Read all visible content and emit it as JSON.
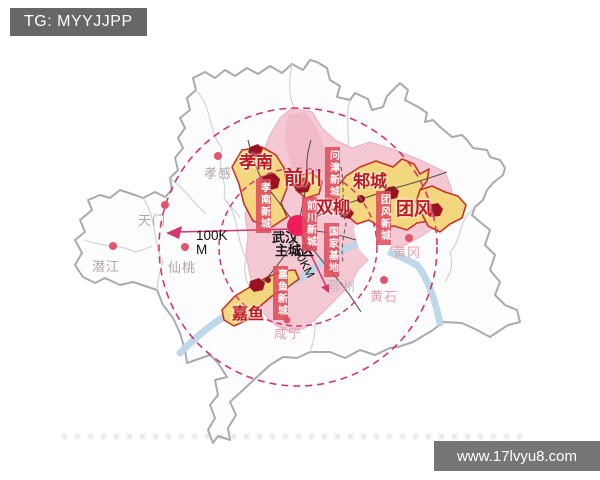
{
  "header": {
    "tg_label": "TG: MYYJJPP"
  },
  "watermark": {
    "url_text": "www.17lvyu8.com"
  },
  "map": {
    "center_label": {
      "line1": "武汉",
      "line2": "主城区"
    },
    "radius_labels": {
      "outer": "100K\nM",
      "inner": "50KM"
    },
    "districts": [
      {
        "label": "孝南"
      },
      {
        "label": "前川"
      },
      {
        "label": "邾城"
      },
      {
        "label": "双柳"
      },
      {
        "label": "团风"
      },
      {
        "label": "嘉鱼"
      }
    ],
    "new_towns": [
      {
        "label": "孝南新城"
      },
      {
        "label": "前川新城"
      },
      {
        "label": "问津新城"
      },
      {
        "label": "团风新城"
      },
      {
        "label": "国家基地"
      },
      {
        "label": "嘉鱼新城"
      }
    ],
    "cities": [
      {
        "label": "孝感"
      },
      {
        "label": "天门"
      },
      {
        "label": "潜江"
      },
      {
        "label": "仙桃"
      },
      {
        "label": "鄂州"
      },
      {
        "label": "黄冈"
      },
      {
        "label": "黄石"
      },
      {
        "label": "咸宁"
      }
    ],
    "colors": {
      "ring": "#d5356f",
      "district_text": "#c2181f",
      "new_town_bg": "#df4d5c",
      "center_dot": "#ee1c5a",
      "highlight_fill": "#f3d77e",
      "metro_fill": "#f5c9d4",
      "river": "#bcd6e8"
    }
  }
}
